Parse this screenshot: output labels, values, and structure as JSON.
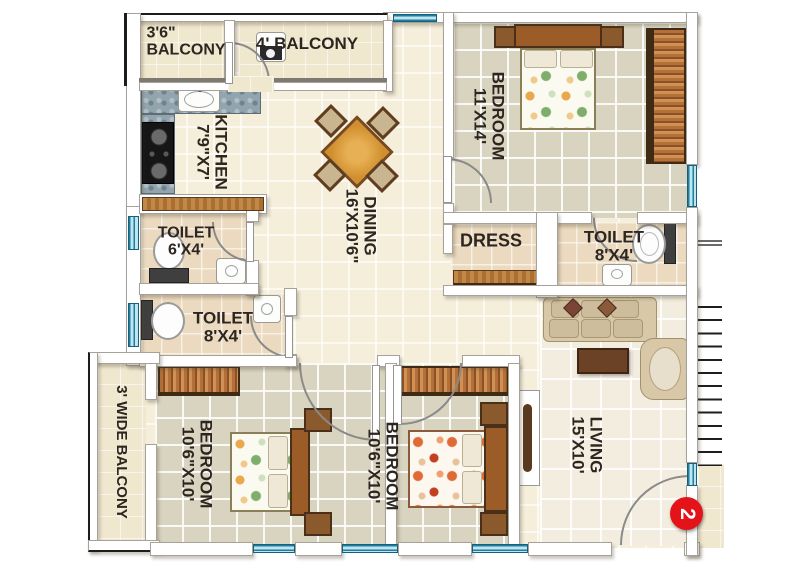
{
  "unit": {
    "number": "2",
    "badge_color": "#e41319"
  },
  "colors": {
    "window_blue": "#1f7f9f",
    "wall": "#ffffff",
    "wood": "#a96f33",
    "bedroom_floor": "#d8d4c0"
  },
  "rooms": {
    "balcony_top_left": {
      "dims": "3'6\"",
      "name": "BALCONY"
    },
    "balcony_top": {
      "name": "4' BALCONY"
    },
    "kitchen": {
      "name": "KITCHEN",
      "dims": "7'9\"X7'"
    },
    "dining": {
      "name": "DINING",
      "dims": "16'X10'6\""
    },
    "bedroom_master": {
      "name": "BEDROOM",
      "dims": "11'X14'"
    },
    "dress": {
      "name": "DRESS"
    },
    "toilet_master": {
      "name": "TOILET",
      "dims": "8'X4'"
    },
    "toilet_small": {
      "name": "TOILET",
      "dims": "6'X4'"
    },
    "toilet_common": {
      "name": "TOILET",
      "dims": "8'X4'"
    },
    "balcony_side": {
      "name": "3' WIDE BALCONY"
    },
    "bedroom_left": {
      "name": "BEDROOM",
      "dims": "10'6\"X10'"
    },
    "bedroom_middle": {
      "name": "BEDROOM",
      "dims": "10'6\"X10'"
    },
    "living": {
      "name": "LIVING",
      "dims": "15'X10'"
    }
  }
}
